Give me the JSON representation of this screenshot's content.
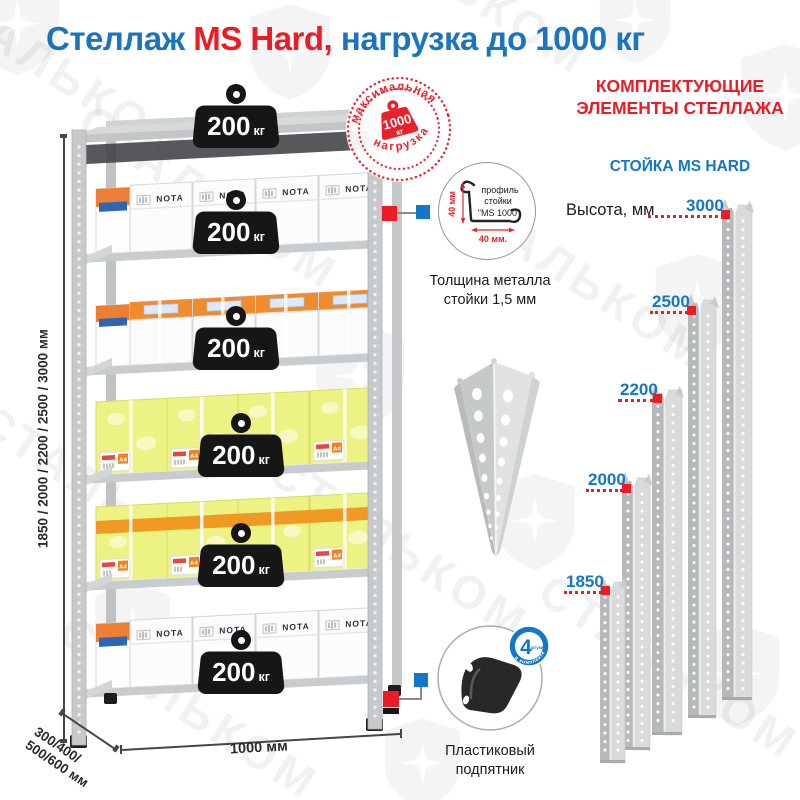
{
  "title": {
    "part1": "Стеллаж ",
    "part2": "MS Hard,",
    "part3": " нагрузка до 1000 кг"
  },
  "watermark": {
    "text": "СТАЛЬКОМ"
  },
  "stamp": {
    "arc_top": "максимальная",
    "arc_bottom": "нагрузка",
    "value": "1000",
    "unit": "кг"
  },
  "shelf": {
    "weights": [
      {
        "value": "200",
        "unit": "кг"
      },
      {
        "value": "200",
        "unit": "кг"
      },
      {
        "value": "200",
        "unit": "кг"
      },
      {
        "value": "200",
        "unit": "кг"
      },
      {
        "value": "200",
        "unit": "кг"
      },
      {
        "value": "200",
        "unit": "кг"
      }
    ],
    "height_label": "1850 / 2000 / 2200 / 2500 / 3000 мм",
    "depth_label": "300/400/\n500/600 мм",
    "width_label": "1000 мм",
    "box_brand": "NOTA",
    "box_size": "A4"
  },
  "profile": {
    "line1": "профиль",
    "line2": "стойки",
    "line3": "\"MS 1000\"",
    "dim_vertical": "40 мм",
    "dim_horizontal": "40 мм.",
    "thickness": "Толщина металла стойки 1,5 мм"
  },
  "foot": {
    "label": "Пластиковый подпятник",
    "badge_value": "4",
    "badge_unit": "штуки",
    "badge_arc": "в комплекте"
  },
  "components": {
    "header_line1": "КОМПЛЕКТУЮЩИЕ",
    "header_line2": "ЭЛЕМЕНТЫ СТЕЛЛАЖА",
    "subheader": "СТОЙКА MS HARD",
    "height_caption": "Высота, мм",
    "heights": [
      {
        "value": "3000"
      },
      {
        "value": "2500"
      },
      {
        "value": "2200"
      },
      {
        "value": "2000"
      },
      {
        "value": "1850"
      }
    ]
  },
  "colors": {
    "blue": "#1b75bc",
    "red": "#ed1c24",
    "accent_blue": "#1377c8"
  }
}
